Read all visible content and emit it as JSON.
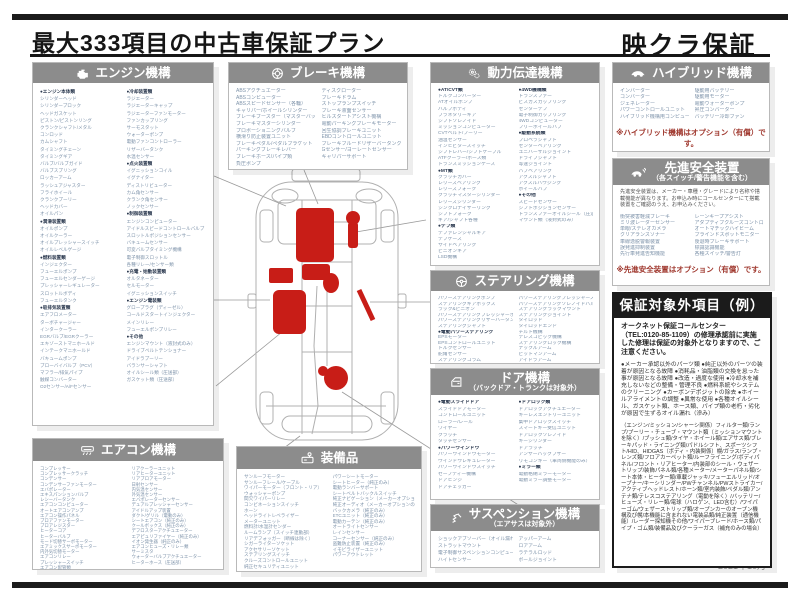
{
  "page": {
    "title": "最大333項目の中古車保証プラン",
    "brand": "映クラ保証",
    "footer_date": "2021年10月"
  },
  "colors": {
    "header_gray": "#8c8c8c",
    "accent_red": "#c81d17",
    "note_red": "#a0392f",
    "list_text": "#7e93aa"
  },
  "sections": {
    "engine": {
      "title": "エンジン機構",
      "col1": [
        "●エンジン本体類",
        "シリンダーヘッド",
        "シリンダーブロック",
        "ヘッドガスケット",
        "ピストン/ピストンリング",
        "クランクシャフト/メタル",
        "コンロッド",
        "カムシャフト",
        "タイミングチェーン",
        "タイミングギア",
        "バルブ/バルブガイド",
        "バルブスプリング",
        "ロッカーアーム",
        "ラッシュアジャスター",
        "フライホイール",
        "クランクプーリー",
        "ヘッドカバー",
        "オイルパン",
        "●潤滑装置類",
        "オイルポンプ",
        "オイルクーラー",
        "オイルプレッシャースイッチ",
        "オイルレベルゲージ",
        "●燃料装置類",
        "インジェクター",
        "フューエルポンプ",
        "フューエルセンダーゲージ",
        "プレッシャーレギュレーター",
        "スロットルボディ",
        "フューエルタンク",
        "●吸排気装置類",
        "エアフロメーター",
        "ターボチャージャー",
        "インタークーラー",
        "EGRバルブ/EGRクーラー",
        "エキゾーストマニホールド",
        "インテークマニホールド",
        "バキュームポンプ",
        "ブローバイバルブ（PCV）",
        "マフラー/排気パイプ",
        "触媒コンバーター",
        "O2センサー/A/Fセンサー"
      ],
      "col2": [
        "●冷却装置類",
        "ラジエーター",
        "ラジエーターキャップ",
        "ラジエーターファンモーター",
        "ファンカップリング",
        "サーモスタット",
        "ウォーターポンプ",
        "電動ファンコントローラー",
        "リザーバータンク",
        "水温センサー",
        "●点火装置類",
        "イグニッションコイル",
        "イグナイター",
        "ディストリビューター",
        "カム角センサー",
        "クランク角センサー",
        "ノックセンサー",
        "●制御装置類",
        "エンジンコンピューター",
        "アイドルスピードコントロールバルブ",
        "スロットルポジションセンサー",
        "バキュームセンサー",
        "可変バルブタイミング機構",
        "電子制御スロットル",
        "各種リレー/センサー類",
        "●充電・始動装置類",
        "オルタネーター",
        "セルモーター",
        "イグニッションスイッチ",
        "●エンジン電装類",
        "グロープラグ（ディーゼル）",
        "コールドスタートインジェクター",
        "メインリレー",
        "フューエルポンプリレー",
        "●その他",
        "エンジンマウント（液封式のみ）",
        "ドライブベルトテンショナー",
        "アイドラプーリー",
        "バランサーシャフト",
        "オイルシール類（圧送部）",
        "ガスケット類（圧送部）"
      ]
    },
    "brake": {
      "title": "ブレーキ機構",
      "col1": [
        "ABSアクチュエーター",
        "ABSコンピューター",
        "ABSスピードセンサー（各輪）",
        "キャリパー/ホイールシリンダー",
        "ブレーキブースター（マスターバック）",
        "ブレーキマスターシリンダー",
        "プロポーショニングバルブ",
        "横滑り防止装置ユニット",
        "ブレーキペダル/ペダルブラケット",
        "パーキングブレーキレバー",
        "ブレーキホース/パイプ類",
        "負圧ポンプ"
      ],
      "col2": [
        "ディスクローター",
        "ブレーキドラム",
        "ストップランプスイッチ",
        "ブレーキ液面センサー",
        "ヒルスタートアシスト機構",
        "電動パーキングブレーキモーター",
        "回生協調ブレーキユニット",
        "EBDコントロールユニット",
        "ブレーキフルードリザーバータンク",
        "Gセンサー/ヨーレートセンサー",
        "キャリパーサポート"
      ]
    },
    "powertrain": {
      "title": "動力伝達機構",
      "col1": [
        "●AT/CVT類",
        "トルクコンバーター",
        "ATオイルポンプ",
        "バルブボディ",
        "プラネタリーギア",
        "シフトソレノイド",
        "ミッションコンピューター",
        "CVTベルト/プーリー",
        "油温センサー",
        "インヒビタースイッチ",
        "シフトレバー/シフトケーブル",
        "ATFクーラー/ホース類",
        "トランスミッションケース",
        "●MT類",
        "クラッチカバー",
        "レリーズベアリング",
        "レリーズフォーク",
        "クラッチマスターシリンダー",
        "レリーズシリンダー",
        "シンクロナイザーリング",
        "シフトフォーク",
        "ギア/シャフト各種",
        "●デフ類",
        "デファレンシャルギア",
        "デフケース",
        "サイドベアリング",
        "ピニオンギア",
        "LSD機構"
      ],
      "col2": [
        "●4WD機構類",
        "トランスファー",
        "ビスカスカップリング",
        "センターデフ",
        "電子制御カップリング",
        "4WDコンピューター",
        "フリーホイールハブ",
        "●駆動系統類",
        "プロペラシャフト",
        "センターベアリング",
        "ユニバーサルジョイント",
        "ドライブシャフト",
        "等速ジョイント",
        "ハブベアリング",
        "アクスルシャフト",
        "アクスルハウジング",
        "ホイールハブ",
        "●その他",
        "スピードセンサー",
        "シフトポジションセンサー",
        "トランスファーオイルシール（圧送部）",
        "マウント類（液封式のみ）"
      ]
    },
    "steering": {
      "title": "ステアリング機構",
      "col1": [
        "パワーステアリングポンプ",
        "ステアリングギアボックス",
        "ラック&ピニオン",
        "パワーステアリングプレッシャーホース",
        "パワーステアリングリザーバータンク",
        "ステアリングシャフト",
        "●電動パワーステアリング",
        "EPSモーター",
        "EPSコントロールユニット",
        "トルクセンサー",
        "舵角センサー",
        "ステアリングコラム"
      ],
      "col2": [
        "パワーステアリングプレッシャースイッチ",
        "パワーステアリングソレノイドバルブ",
        "ステアリングラックマウント",
        "ステアリングジョイント",
        "タイロッド",
        "タイロッドエンド",
        "チルト機構",
        "テレスコピック機構",
        "ステアリングロック機構",
        "ナックルアーム",
        "ピットマンアーム",
        "アイドラアーム"
      ]
    },
    "door": {
      "title": "ドア機構",
      "subtitle": "（バックドア・トランクは対象外）",
      "col1": [
        "●電動スライドドア",
        "スライドドアモーター",
        "コントロールユニット",
        "ローラー/レール",
        "ワイヤー",
        "クラッチ",
        "タッチセンサー",
        "●パワーウインドウ",
        "パワーウインドウモーター",
        "ウインドウレギュレーター",
        "パワーウインドウスイッチ",
        "セーフティー機構",
        "ドアヒンジ",
        "ドアチェッカー"
      ],
      "col2": [
        "●ドアロック類",
        "ドアロックアクチュエーター",
        "キーレスエントリーユニット",
        "集中ドアロックスイッチ",
        "スマートキー受信ユニット",
        "ドアロックソレノイド",
        "キーシリンダー",
        "ドアラッチ",
        "アンサーバックブザー",
        "リモコンキー（車両側機能のみ）",
        "●ミラー類",
        "電動格納ミラーモーター",
        "電動ミラー調整モーター"
      ]
    },
    "aircon": {
      "title": "エアコン機構",
      "col1": [
        "コンプレッサー",
        "コンプレッサークラッチ",
        "コンデンサー",
        "コンデンサーファンモーター",
        "エバポレーター",
        "エキスパンションバルブ",
        "レシーバータンク",
        "エアコンコンピューター",
        "オートエアコンアンプ",
        "エアコン操作パネル",
        "ブロアファンモーター",
        "ブロアレジスター",
        "ヒーターコア",
        "ヒーターバルブ",
        "モード切替サーボモーター",
        "エアミックスサーボモーター",
        "内外気切替モーター",
        "エアコンリレー",
        "プレッシャースイッチ",
        "エアコン配管類"
      ],
      "col2": [
        "リアクーラーユニット",
        "リアヒーターユニット",
        "リアブロアモーター",
        "日射センサー",
        "内気温センサー",
        "外気温センサー",
        "エバポレーターセンサー",
        "デュアルプレッシャーセンサー",
        "アイドルアップ装置",
        "ダクト/グリル（電動のみ）",
        "シートエアコン（純正のみ）",
        "クールボックス（純正のみ）",
        "デフロスターアクチュエーター",
        "エアピュリファイヤー（純正のみ）",
        "イオン発生器（純正のみ）",
        "エアコンヒューズ・リレー類",
        "サーミスタ",
        "ウォーターバルブアクチュエーター",
        "ヒーターホース（圧送部）"
      ]
    },
    "equipment": {
      "title": "装備品",
      "col1": [
        "サンルーフモーター",
        "サンルーフレール/ケーブル",
        "ワイパーモーター（フロント・リア）",
        "ウォッシャーポンプ",
        "間欠ワイパーリレー",
        "コンビネーションスイッチ",
        "ホーン",
        "ヘッドライトレベライザー",
        "メーターユニット",
        "燃料計/水温計センダー",
        "ルームランプ（スイッチ連動部）",
        "リアデフォッガー（断線は除く）",
        "シガーライターソケット",
        "アクセサリーソケット",
        "ステアリングスイッチ",
        "クルーズコントロールユニット",
        "純正セキュリティユニット"
      ],
      "col2": [
        "パワーシートモーター",
        "シートヒーター（純正のみ）",
        "電動ランバーサポート",
        "シートベルトバックルスイッチ",
        "純正ナビゲーション（メーカーオプションのみ）",
        "純正オーディオ（メーカーオプションのみ）",
        "バックカメラ（純正のみ）",
        "ETCユニット（純正のみ）",
        "電動カーテン（純正のみ）",
        "オートライトセンサー",
        "レインセンサー",
        "コーナーセンサー（純正のみ）",
        "盗難防止装置（純正のみ）",
        "イモビライザーユニット",
        "パワーアウトレット"
      ]
    },
    "suspension": {
      "title": "サスペンション機構",
      "subtitle": "（エアサスは対象外）",
      "col1": [
        "ショックアブソーバー（オイル漏れのみ対象）",
        "ストラットマウント",
        "電子制御サスペンションコンピューター",
        "ハイトセンサー"
      ],
      "col2": [
        "アッパーアーム",
        "ロアアーム",
        "ラテラルロッド",
        "ボールジョイント"
      ]
    },
    "hybrid": {
      "title": "ハイブリッド機構",
      "col1": [
        "インバーター",
        "コンバーター",
        "ジェネレーター",
        "パワーコントロールユニット",
        "ハイブリッド機構用コンピューター"
      ],
      "col2": [
        "駆動用バッテリー",
        "駆動用モーター",
        "電動ウォーターポンプ",
        "昇圧コンバーター",
        "バッテリー冷却ファン"
      ],
      "note": "※ハイブリッド機構はオプション（有償）です。"
    },
    "safety": {
      "title": "先進安全装置",
      "subtitle": "（各スイッチ/警告機能を含む）",
      "intro": "先進安全装置は、メーカー・車種・グレードにより名称や搭載機能が異なります。お申込み時にコールセンターにて搭載装置をご確認のうえ、お申込みください。",
      "col1": [
        "衝突被害軽減ブレーキ",
        "ミリ波レーダーセンサー",
        "単眼/ステレオカメラ",
        "クリアランスソナー",
        "車線逸脱警報装置",
        "誤発進抑制装置",
        "先行車発進告知機能"
      ],
      "col2": [
        "レーンキープアシスト",
        "アダプティブクルーズコントロール",
        "オートマチックハイビーム",
        "ブラインドスポットモニター",
        "後退時ブレーキサポート",
        "標識認識機能",
        "各種スイッチ/警告灯"
      ],
      "note": "※先進安全装置はオプション（有償）です。"
    },
    "excluded": {
      "title": "保証対象外項目（例）",
      "intro": "オークネット保証コールセンター（TEL:0120-85-1109）の修理承認前に実施した修理は保証の対象外となりますので、ご注意ください。",
      "bullets": "●メーカー承認以外のパーツ類 ●純正以外のパーツの装着が原因となる故障 ●消耗品・油脂類の交換を怠った事が原因となる故障 ●改造・過度な使用 ●冷却水を補充しないなどの整備・管理不良 ●燃料系統やシステムのクリーニング ●カーボンデポジットの除去 ●ホイールアライメントの調整 ●異常な使用 ●各種オイルシール、ガスケット類、ホース類、パイプ類の老朽・劣化が原因で生ずるオイル漏れ（滲み）",
      "detail": "（エンジン/ミッション/シャーシ関係）フィルター類/ランプ/プーリー・チューブ・マウント類（ミッションマウントを除く）/ブッシュ類/タイヤ・ホイール類/エアサス類/ブレーキパッド・ライニング類/パドルシフト、スポーツシフト/HID、HIDGAS（ボディ・内装関係）幌/ガラス/ランプ・レンズ類/フロアカーペット類/ルーフライニング/ボディパネル/フロント・リアヒーター/内装部のシール・ウェザートリップ/装飾パネル類/各種メーター/メーターパネル類/シート本体・ヒーター類/車載ジャッキ/フューエルリッド/オープナー/キーシリンダー/PWチャンネル/PWストライカー/アクティブヘッドレスト/ホーン類/室内装飾/ペダル類/アンテナ類/テレスコステアリング（電動を除く）/バッテリー/ヒューズ・リレー類/電球（ハロゲン、LED含む）/ワイパーゴム/ウェザーストリップ類/オープンカーのオープン機構及び幌/本機能に含まれない電装品類/純正装置（通信機能）/レーダー探知機その他/ワイパーブレード/ホース類/パイプ・ゴム類/装備品及びクーラーガス（補充のみの場合）"
    }
  }
}
